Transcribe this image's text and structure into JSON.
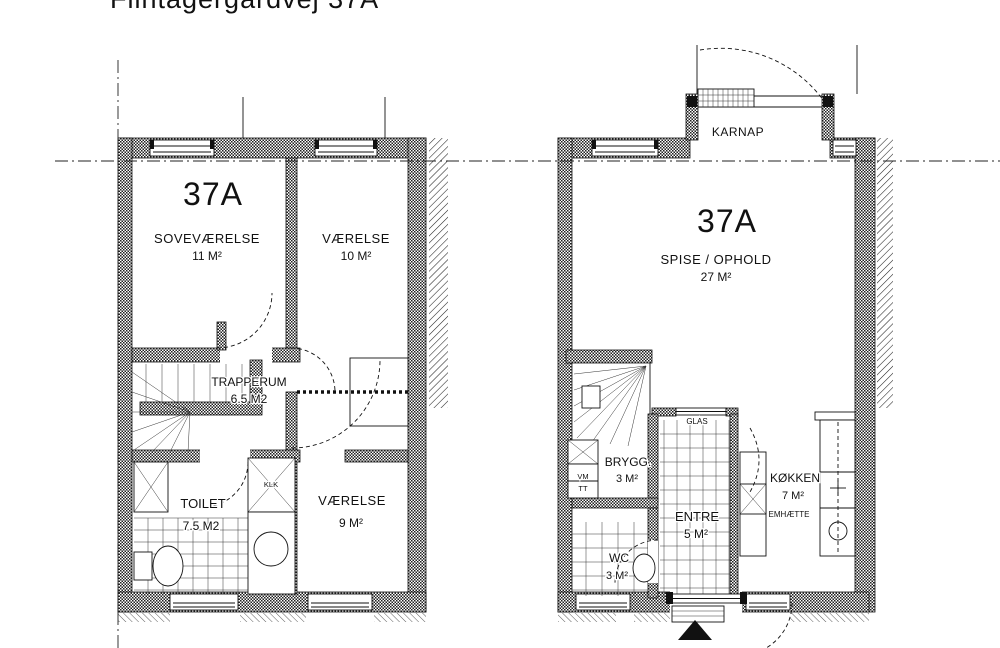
{
  "title": "Flintagergårdvej 37A",
  "colors": {
    "ink": "#111111",
    "paper": "#ffffff"
  },
  "floor_upper": {
    "unit": "37A",
    "sovevaerelse": {
      "name": "SOVEVÆRELSE",
      "area": "11 M²"
    },
    "vaerelse10": {
      "name": "VÆRELSE",
      "area": "10 M²"
    },
    "trapperum": {
      "name": "TRAPPERUM",
      "area": "6.5 M2"
    },
    "toilet": {
      "name": "TOILET",
      "area": "7.5 M2"
    },
    "vaerelse9": {
      "name": "VÆRELSE",
      "area": "9 M²"
    },
    "closet": "KLK"
  },
  "floor_ground": {
    "unit": "37A",
    "karnap": "KARNAP",
    "spise_ophold": {
      "name": "SPISE / OPHOLD",
      "area": "27 M²"
    },
    "brygg": {
      "name": "BRYGG.",
      "area": "3 M²"
    },
    "entre": {
      "name": "ENTRE",
      "area": "5 M²"
    },
    "koekken": {
      "name": "KØKKEN",
      "area": "7 M²"
    },
    "wc": {
      "name": "WC",
      "area": "3 M²"
    },
    "glas": "GLAS",
    "emhaette": "EMHÆTTE",
    "vm": "VM",
    "tt": "TT"
  }
}
